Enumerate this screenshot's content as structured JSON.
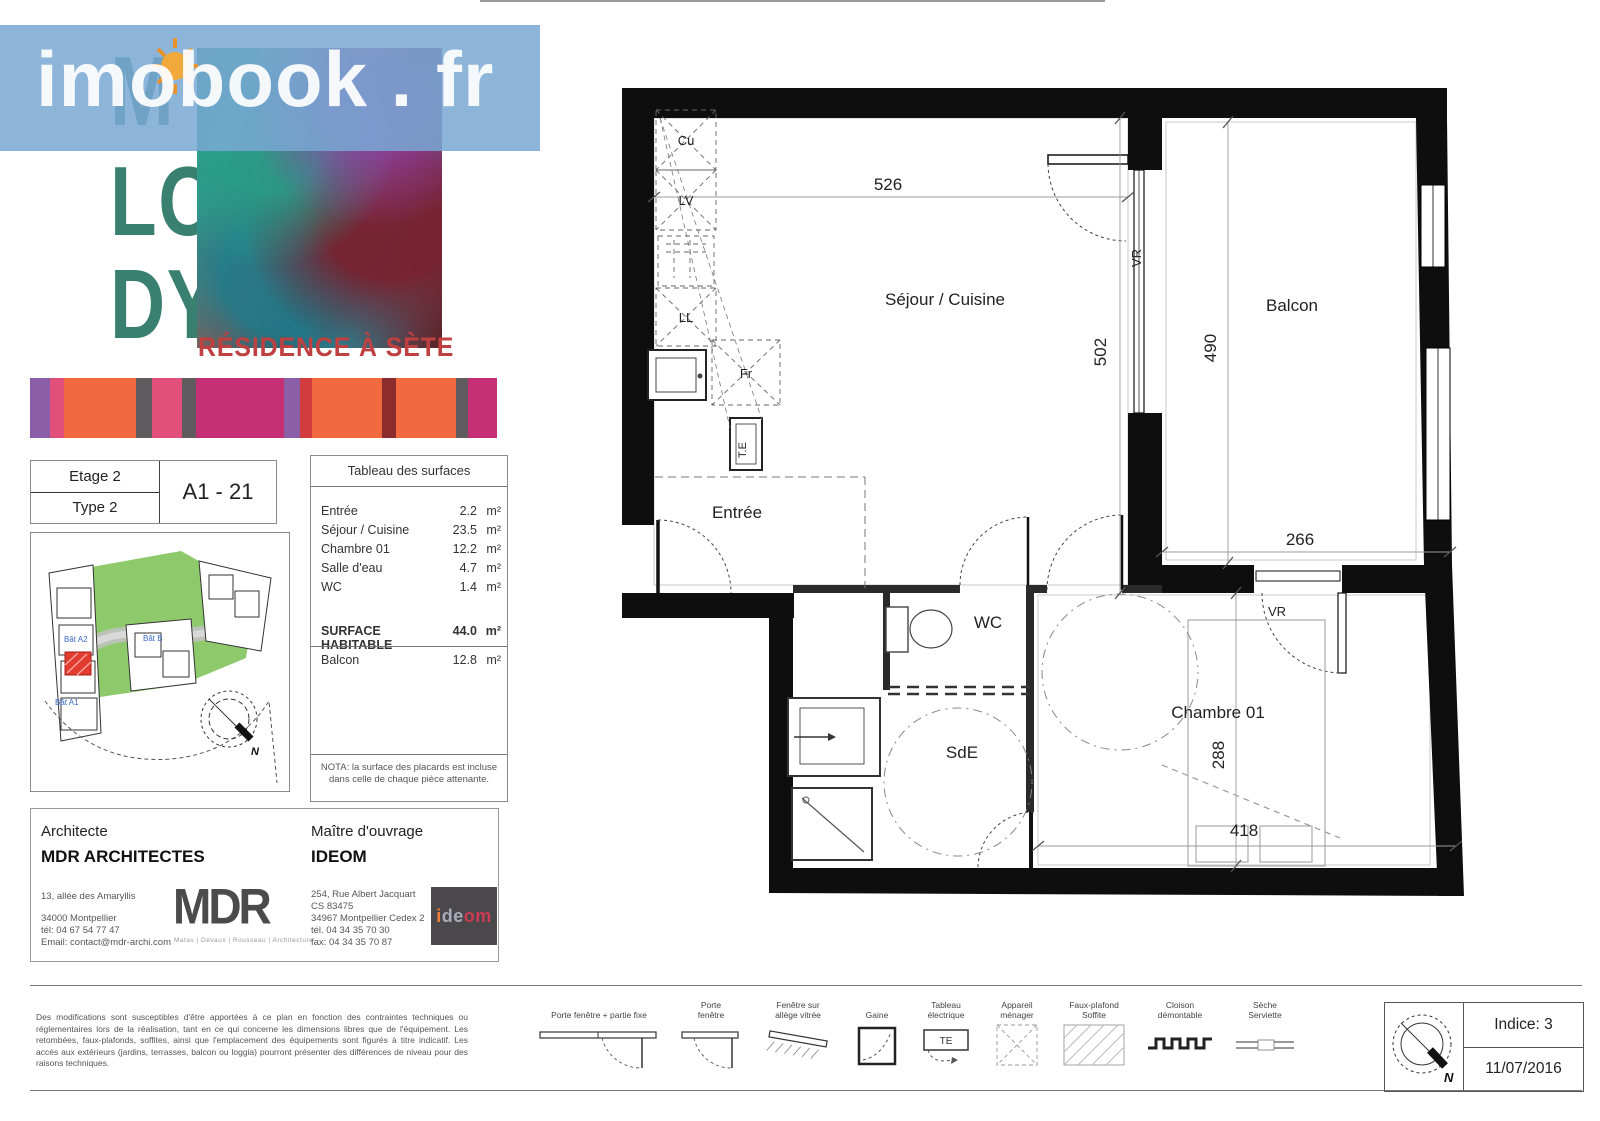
{
  "watermark": {
    "text": "imobook . fr",
    "band_color": "#79a8d4"
  },
  "brand": {
    "name": "MELODY",
    "row1": "M",
    "row2": "LO",
    "row3": "DY",
    "subtitle": "RÉSIDENCE À SÈTE",
    "letter_color": "#3a8071",
    "subtitle_color": "#bf4040"
  },
  "stripes": {
    "palette": [
      "#8b5fa8",
      "#e0507a",
      "#f2683f",
      "#5f5b5e",
      "#c62f74",
      "#d23c3c",
      "#8c2c2c"
    ]
  },
  "unit": {
    "etage": "Etage 2",
    "type": "Type 2",
    "code": "A1 - 21"
  },
  "siteplan": {
    "bat_a2": "Bât A2",
    "bat_b": "Bât B",
    "bat_a1": "Bât A1",
    "north": "N",
    "highlight_color": "#e23b30"
  },
  "surfaces": {
    "title": "Tableau des surfaces",
    "rows": [
      {
        "label": "Entrée",
        "value": "2.2",
        "unit": "m²"
      },
      {
        "label": "Séjour / Cuisine",
        "value": "23.5",
        "unit": "m²"
      },
      {
        "label": "Chambre 01",
        "value": "12.2",
        "unit": "m²"
      },
      {
        "label": "Salle d'eau",
        "value": "4.7",
        "unit": "m²"
      },
      {
        "label": "WC",
        "value": "1.4",
        "unit": "m²"
      }
    ],
    "total_label": "SURFACE HABITABLE",
    "total_value": "44.0",
    "total_unit": "m²",
    "balcon_label": "Balcon",
    "balcon_value": "12.8",
    "balcon_unit": "m²",
    "nota": "NOTA: la surface des placards est incluse dans celle de chaque pièce attenante."
  },
  "architect": {
    "heading": "Architecte",
    "name": "MDR ARCHITECTES",
    "addr1": "13, allée des Amaryllis",
    "addr2": "34000 Montpellier",
    "addr3": "tél: 04 67 54 77 47",
    "addr4": "Email: contact@mdr-archi.com",
    "logo": "MDR",
    "tagline": "Matas | Devaux | Rousseau | Architecture"
  },
  "owner": {
    "heading": "Maître d'ouvrage",
    "name": "IDEOM",
    "addr1": "254, Rue Albert Jacquart",
    "addr2": "CS 83475",
    "addr3": "34967 Montpellier Cedex 2",
    "addr4": "tél. 04 34 35 70 30",
    "addr5": "fax: 04 34 35 70 87",
    "logo_i": "i",
    "logo_de": "de",
    "logo_om": "om"
  },
  "plan": {
    "labels": {
      "cu": "Cu",
      "lv": "LV",
      "ll": "LL",
      "fr": "Fr",
      "te": "T.E",
      "sejour": "Séjour / Cuisine",
      "entree": "Entrée",
      "wc": "WC",
      "sde": "SdE",
      "chambre": "Chambre 01",
      "balcon": "Balcon",
      "vr_sejour": "VR",
      "vr_chambre": "VR"
    },
    "dims": {
      "sejour_w": "526",
      "sejour_h": "502",
      "balcon_h": "490",
      "balcon_w": "266",
      "chambre_h": "288",
      "chambre_w": "418"
    }
  },
  "legend": {
    "items": [
      {
        "label": "Porte fenêtre + partie fixe"
      },
      {
        "label": "Porte\nfenêtre"
      },
      {
        "label": "Fenêtre sur\nallège vitrée"
      },
      {
        "label": "Gaine"
      },
      {
        "label": "Tableau\nélectrique",
        "icon_text": "TE"
      },
      {
        "label": "Appareil\nménager"
      },
      {
        "label": "Faux-plafond\nSoffite"
      },
      {
        "label": "Cloison\ndémontable"
      },
      {
        "label": "Sèche\nServiette"
      }
    ]
  },
  "titleblock": {
    "indice": "Indice: 3",
    "date": "11/07/2016",
    "north": "N"
  },
  "disclaimer": {
    "text": "Des modifications sont susceptibles d'être apportées à ce plan en fonction des contraintes techniques ou réglementaires lors de la réalisation, tant en ce qui concerne les dimensions libres que de l'équipement. Les retombées, faux-plafonds, soffites, ainsi que l'emplacement des équipements sont figurés à titre indicatif. Les accès aux extérieurs (jardins, terrasses, balcon ou loggia) pourront présenter des différences de niveau pour des raisons techniques."
  }
}
